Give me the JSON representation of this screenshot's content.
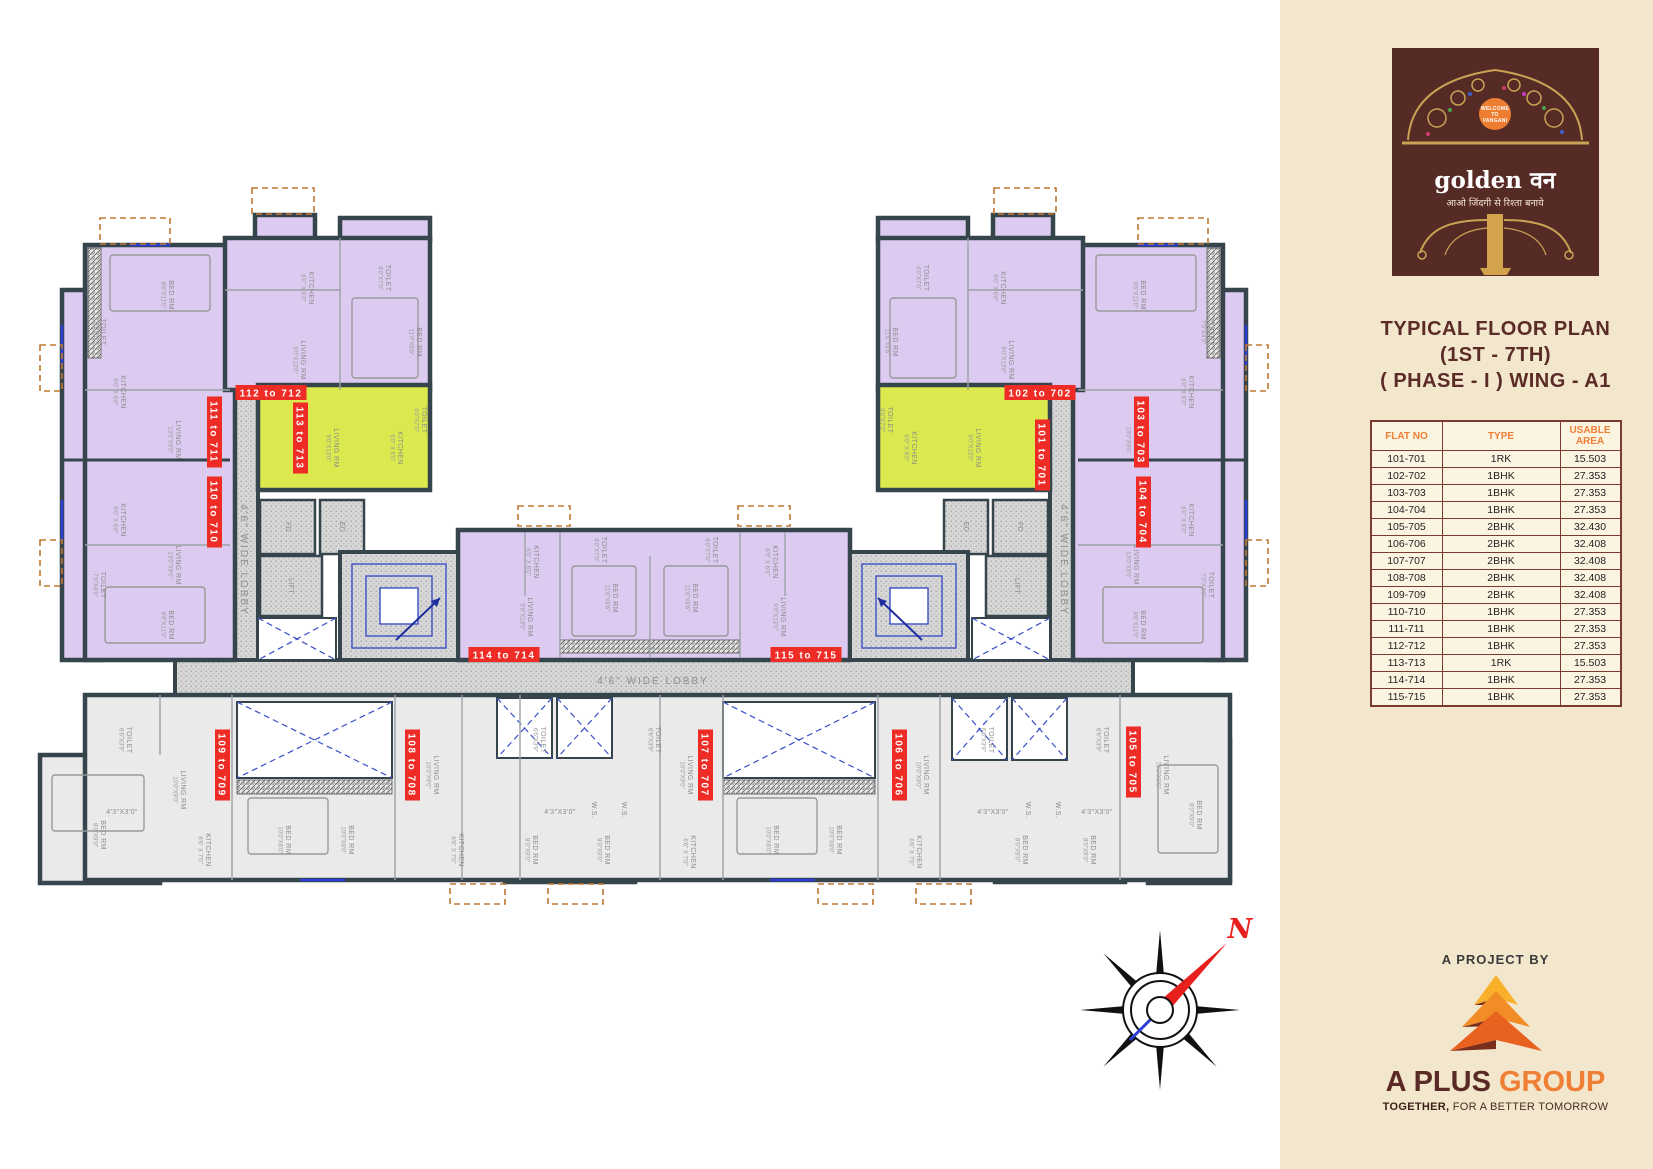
{
  "panel": {
    "logo": {
      "welcome_lines": [
        "WELCOME",
        "TO",
        "VANGANI"
      ],
      "brand": "golden वन",
      "tagline": "आओ जिंदगी से रिश्ता बनाये"
    },
    "title_lines": [
      "TYPICAL FLOOR PLAN",
      "(1ST - 7TH)",
      "( PHASE - I ) WING - A1"
    ],
    "table": {
      "headers": [
        "FLAT NO",
        "TYPE",
        "USABLE AREA"
      ],
      "rows": [
        [
          "101-701",
          "1RK",
          "15.503"
        ],
        [
          "102-702",
          "1BHK",
          "27.353"
        ],
        [
          "103-703",
          "1BHK",
          "27.353"
        ],
        [
          "104-704",
          "1BHK",
          "27.353"
        ],
        [
          "105-705",
          "2BHK",
          "32.430"
        ],
        [
          "106-706",
          "2BHK",
          "32.408"
        ],
        [
          "107-707",
          "2BHK",
          "32.408"
        ],
        [
          "108-708",
          "2BHK",
          "32.408"
        ],
        [
          "109-709",
          "2BHK",
          "32.408"
        ],
        [
          "110-710",
          "1BHK",
          "27.353"
        ],
        [
          "111-711",
          "1BHK",
          "27.353"
        ],
        [
          "112-712",
          "1BHK",
          "27.353"
        ],
        [
          "113-713",
          "1RK",
          "15.503"
        ],
        [
          "114-714",
          "1BHK",
          "27.353"
        ],
        [
          "115-715",
          "1BHK",
          "27.353"
        ]
      ]
    },
    "project": {
      "kicker": "A PROJECT BY",
      "name_bold": "A PLUS",
      "name_light": "GROUP",
      "tagline_bold": "TOGETHER,",
      "tagline_rest": " FOR A BETTER TOMORROW"
    }
  },
  "plan": {
    "compass_label": "N",
    "lobby_labels": [
      {
        "text": "4'6\" WIDE LOBBY",
        "x": 244,
        "y": 560,
        "r": 90
      },
      {
        "text": "4'6\" WIDE LOBBY",
        "x": 1064,
        "y": 560,
        "r": 90
      },
      {
        "text": "4'6\" WIDE LOBBY",
        "x": 653,
        "y": 681,
        "r": 0
      }
    ],
    "flat_labels": [
      {
        "text": "111 to 711",
        "x": 214,
        "y": 432,
        "r": 90
      },
      {
        "text": "110 to 710",
        "x": 214,
        "y": 512,
        "r": 90
      },
      {
        "text": "112 to 712",
        "x": 271,
        "y": 393,
        "r": 0
      },
      {
        "text": "113 to 713",
        "x": 300,
        "y": 438,
        "r": 90
      },
      {
        "text": "102 to 702",
        "x": 1040,
        "y": 393,
        "r": 0
      },
      {
        "text": "101 to 701",
        "x": 1042,
        "y": 455,
        "r": 90
      },
      {
        "text": "103 to 703",
        "x": 1141,
        "y": 432,
        "r": 90
      },
      {
        "text": "104 to 704",
        "x": 1143,
        "y": 512,
        "r": 90
      },
      {
        "text": "114 to 714",
        "x": 504,
        "y": 655,
        "r": 0
      },
      {
        "text": "115 to 715",
        "x": 806,
        "y": 655,
        "r": 0
      },
      {
        "text": "109 to 709",
        "x": 222,
        "y": 765,
        "r": 90
      },
      {
        "text": "108 to 708",
        "x": 412,
        "y": 765,
        "r": 90
      },
      {
        "text": "107 to 707",
        "x": 705,
        "y": 765,
        "r": 90
      },
      {
        "text": "106 to 706",
        "x": 899,
        "y": 765,
        "r": 90
      },
      {
        "text": "105 to 705",
        "x": 1133,
        "y": 762,
        "r": 90
      }
    ],
    "room_labels": [
      {
        "t": "BED RM",
        "d": "8'6\"X11'0\"",
        "x": 168,
        "y": 295,
        "r": 90
      },
      {
        "t": "TOILET",
        "d": "7'0\"X4'0\"",
        "x": 100,
        "y": 332,
        "r": 90
      },
      {
        "t": "KITCHEN",
        "d": "6'0\" X 6'0\"",
        "x": 120,
        "y": 392,
        "r": 90
      },
      {
        "t": "LIVING RM",
        "d": "13'0\"X9'0\"",
        "x": 175,
        "y": 440,
        "r": 90
      },
      {
        "t": "KITCHEN",
        "d": "6'0\" X 6'0\"",
        "x": 120,
        "y": 520,
        "r": 90
      },
      {
        "t": "TOILET",
        "d": "7'0\"X4'0\"",
        "x": 100,
        "y": 585,
        "r": 90
      },
      {
        "t": "LIVING RM",
        "d": "13'0\"X9'0\"",
        "x": 175,
        "y": 565,
        "r": 90
      },
      {
        "t": "BED RM",
        "d": "8'6\"X11'0\"",
        "x": 168,
        "y": 625,
        "r": 90
      },
      {
        "t": "KITCHEN",
        "d": "6'0\" X 6'0\"",
        "x": 308,
        "y": 288,
        "r": 90
      },
      {
        "t": "TOILET",
        "d": "4'0\"X7'0\"",
        "x": 385,
        "y": 278,
        "r": 90
      },
      {
        "t": "LIVING RM",
        "d": "9'0\"X13'0\"",
        "x": 300,
        "y": 360,
        "r": 90
      },
      {
        "t": "BED RM",
        "d": "11'0\"X8'6\"",
        "x": 416,
        "y": 342,
        "r": 90
      },
      {
        "t": "LIVING RM",
        "d": "9'0\"X13'0\"",
        "x": 333,
        "y": 448,
        "r": 90
      },
      {
        "t": "KITCHEN",
        "d": "6'0\" X 6'0\"",
        "x": 397,
        "y": 448,
        "r": 90
      },
      {
        "t": "TOILET",
        "d": "4'0\"X7'0\"",
        "x": 421,
        "y": 420,
        "r": 90
      },
      {
        "t": "FD",
        "d": "",
        "x": 288,
        "y": 527,
        "r": 90
      },
      {
        "t": "ED",
        "d": "",
        "x": 342,
        "y": 527,
        "r": 90
      },
      {
        "t": "LIFT",
        "d": "",
        "x": 291,
        "y": 586,
        "r": 90
      },
      {
        "t": "BED RM",
        "d": "8'6\"X11'0\"",
        "x": 1140,
        "y": 295,
        "r": 90
      },
      {
        "t": "TOILET",
        "d": "7'0\"X4'0\"",
        "x": 1208,
        "y": 332,
        "r": 90
      },
      {
        "t": "KITCHEN",
        "d": "6'0\" X 6'0\"",
        "x": 1188,
        "y": 392,
        "r": 90
      },
      {
        "t": "LIVING RM",
        "d": "13'0\"X9'0\"",
        "x": 1133,
        "y": 440,
        "r": 90
      },
      {
        "t": "KITCHEN",
        "d": "6'0\" X 6'0\"",
        "x": 1188,
        "y": 520,
        "r": 90
      },
      {
        "t": "TOILET",
        "d": "7'0\"X4'0\"",
        "x": 1208,
        "y": 585,
        "r": 90
      },
      {
        "t": "LIVING RM",
        "d": "13'0\"X9'0\"",
        "x": 1133,
        "y": 565,
        "r": 90
      },
      {
        "t": "BED RM",
        "d": "8'6\"X11'0\"",
        "x": 1140,
        "y": 625,
        "r": 90
      },
      {
        "t": "KITCHEN",
        "d": "6'0\" X 6'0\"",
        "x": 1000,
        "y": 288,
        "r": 90
      },
      {
        "t": "TOILET",
        "d": "4'0\"X7'0\"",
        "x": 923,
        "y": 278,
        "r": 90
      },
      {
        "t": "LIVING RM",
        "d": "9'0\"X13'0\"",
        "x": 1008,
        "y": 360,
        "r": 90
      },
      {
        "t": "BED RM",
        "d": "11'0\"X8'6\"",
        "x": 892,
        "y": 342,
        "r": 90
      },
      {
        "t": "LIVING RM",
        "d": "9'0\"X13'0\"",
        "x": 975,
        "y": 448,
        "r": 90
      },
      {
        "t": "KITCHEN",
        "d": "6'0\" X 6'0\"",
        "x": 911,
        "y": 448,
        "r": 90
      },
      {
        "t": "TOILET",
        "d": "4'0\"X7'0\"",
        "x": 887,
        "y": 420,
        "r": 90
      },
      {
        "t": "FD",
        "d": "",
        "x": 1020,
        "y": 527,
        "r": 90
      },
      {
        "t": "ED",
        "d": "",
        "x": 966,
        "y": 527,
        "r": 90
      },
      {
        "t": "LIFT",
        "d": "",
        "x": 1017,
        "y": 586,
        "r": 90
      },
      {
        "t": "KITCHEN",
        "d": "6'0\" X 6'0\"",
        "x": 533,
        "y": 562,
        "r": 90
      },
      {
        "t": "TOILET",
        "d": "4'0\"X7'0\"",
        "x": 601,
        "y": 550,
        "r": 90
      },
      {
        "t": "LIVING RM",
        "d": "9'0\"X13'0\"",
        "x": 527,
        "y": 617,
        "r": 90
      },
      {
        "t": "BED RM",
        "d": "11'0\"X8'6\"",
        "x": 612,
        "y": 598,
        "r": 90
      },
      {
        "t": "BED RM",
        "d": "11'0\"X8'6\"",
        "x": 692,
        "y": 598,
        "r": 90
      },
      {
        "t": "TOILET",
        "d": "4'0\"X7'0\"",
        "x": 712,
        "y": 550,
        "r": 90
      },
      {
        "t": "KITCHEN",
        "d": "6'0\" X 6'0\"",
        "x": 772,
        "y": 562,
        "r": 90
      },
      {
        "t": "LIVING RM",
        "d": "9'0\"X13'0\"",
        "x": 780,
        "y": 617,
        "r": 90
      },
      {
        "t": "TOILET",
        "d": "6'6\"X3'9\"",
        "x": 126,
        "y": 740,
        "r": 90
      },
      {
        "t": "LIVING RM",
        "d": "10'0\"X9'0\"",
        "x": 180,
        "y": 790,
        "r": 90
      },
      {
        "t": "KITCHEN",
        "d": "6'6\" X 7'0\"",
        "x": 205,
        "y": 850,
        "r": 90
      },
      {
        "t": "4'3\"X3'0\"",
        "d": "",
        "x": 122,
        "y": 812,
        "r": 0
      },
      {
        "t": "BED RM",
        "d": "8'0\"X9'0\"",
        "x": 100,
        "y": 835,
        "r": 90
      },
      {
        "t": "BED RM",
        "d": "10'0\"X8'0\"",
        "x": 285,
        "y": 840,
        "r": 90
      },
      {
        "t": "BED RM",
        "d": "10'0\"X8'0\"",
        "x": 348,
        "y": 840,
        "r": 90
      },
      {
        "t": "LIVING RM",
        "d": "10'0\"X9'0\"",
        "x": 433,
        "y": 775,
        "r": 90
      },
      {
        "t": "KITCHEN",
        "d": "6'6\" X 7'0\"",
        "x": 458,
        "y": 850,
        "r": 90
      },
      {
        "t": "TOILET",
        "d": "6'6\"X3'9\"",
        "x": 540,
        "y": 740,
        "r": 90
      },
      {
        "t": "TOILET",
        "d": "6'6\"X3'9\"",
        "x": 655,
        "y": 740,
        "r": 90
      },
      {
        "t": "W.S.",
        "d": "",
        "x": 594,
        "y": 810,
        "r": 90
      },
      {
        "t": "W.S.",
        "d": "",
        "x": 624,
        "y": 810,
        "r": 90
      },
      {
        "t": "4'3\"X3'0\"",
        "d": "",
        "x": 560,
        "y": 812,
        "r": 0
      },
      {
        "t": "BED RM",
        "d": "8'0\"X9'0\"",
        "x": 532,
        "y": 850,
        "r": 90
      },
      {
        "t": "BED RM",
        "d": "8'0\"X9'0\"",
        "x": 604,
        "y": 850,
        "r": 90
      },
      {
        "t": "LIVING RM",
        "d": "10'0\"X9'0\"",
        "x": 687,
        "y": 775,
        "r": 90
      },
      {
        "t": "KITCHEN",
        "d": "6'6\" X 7'0\"",
        "x": 690,
        "y": 852,
        "r": 90
      },
      {
        "t": "BED RM",
        "d": "10'0\"X8'0\"",
        "x": 773,
        "y": 840,
        "r": 90
      },
      {
        "t": "BED RM",
        "d": "10'0\"X8'0\"",
        "x": 836,
        "y": 840,
        "r": 90
      },
      {
        "t": "LIVING RM",
        "d": "10'0\"X9'0\"",
        "x": 923,
        "y": 775,
        "r": 90
      },
      {
        "t": "KITCHEN",
        "d": "6'6\" X 7'0\"",
        "x": 916,
        "y": 852,
        "r": 90
      },
      {
        "t": "TOILET",
        "d": "6'6\"X3'9\"",
        "x": 988,
        "y": 740,
        "r": 90
      },
      {
        "t": "4'3\"X3'0\"",
        "d": "",
        "x": 993,
        "y": 812,
        "r": 0
      },
      {
        "t": "W.S.",
        "d": "",
        "x": 1028,
        "y": 810,
        "r": 90
      },
      {
        "t": "W.S.",
        "d": "",
        "x": 1058,
        "y": 810,
        "r": 90
      },
      {
        "t": "4'3\"X3'0\"",
        "d": "",
        "x": 1097,
        "y": 812,
        "r": 0
      },
      {
        "t": "TOILET",
        "d": "6'6\"X3'9\"",
        "x": 1103,
        "y": 740,
        "r": 90
      },
      {
        "t": "BED RM",
        "d": "8'0\"X9'0\"",
        "x": 1022,
        "y": 850,
        "r": 90
      },
      {
        "t": "BED RM",
        "d": "8'0\"X9'0\"",
        "x": 1090,
        "y": 850,
        "r": 90
      },
      {
        "t": "LIVING RM",
        "d": "10'0\"X9'0\"",
        "x": 1163,
        "y": 775,
        "r": 90
      },
      {
        "t": "BED RM",
        "d": "8'0\"X9'0\"",
        "x": 1196,
        "y": 815,
        "r": 90
      }
    ]
  },
  "colors": {
    "panel_bg": "#f2e6cd",
    "logo_maroon": "#572b25",
    "accent_orange": "#ef7f35",
    "table_border": "#7b3b33",
    "title_maroon": "#5b2b28",
    "flat_purple": "#dccaf0",
    "flat_yellow": "#dbe94e",
    "flat_gray": "#eaeaea",
    "wall": "#36454c",
    "label_red": "#ee2b24",
    "north_red": "#e8201d"
  }
}
